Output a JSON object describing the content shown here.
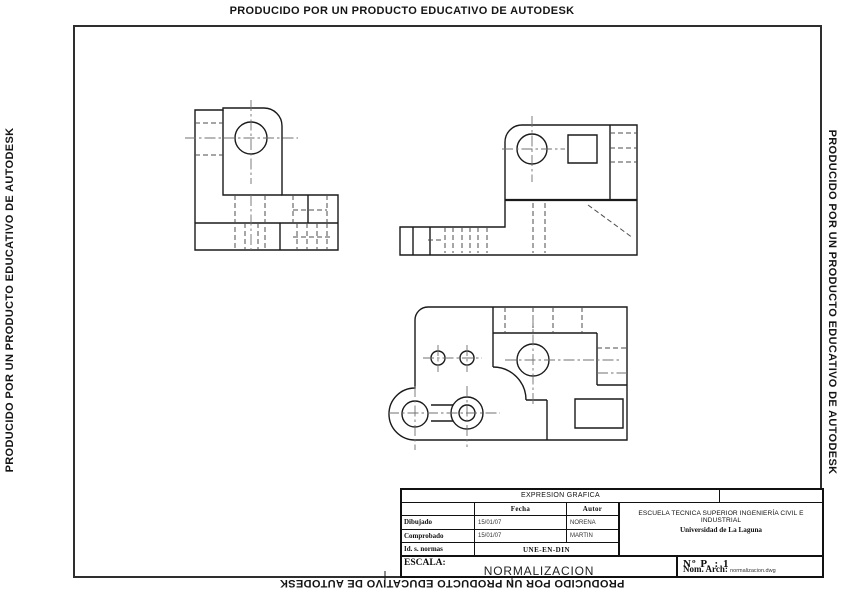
{
  "banners": {
    "top": "PRODUCIDO POR UN PRODUCTO EDUCATIVO DE AUTODESK",
    "left": "PRODUCIDO POR UN PRODUCTO EDUCATIVO DE AUTODESK",
    "right": "PRODUCIDO POR UN PRODUCTO EDUCATIVO DE AUTODESK",
    "bottom": "PRODUCIDO POR UN PRODUCTO EDUCATIVO DE AUTODESK"
  },
  "title_block": {
    "header": "EXPRESION GRAFICA",
    "columns": {
      "fecha": "Fecha",
      "autor": "Autor"
    },
    "rows": [
      {
        "label": "Dibujado",
        "fecha": "15/01/07",
        "autor": "NORENA"
      },
      {
        "label": "Comprobado",
        "fecha": "15/01/07",
        "autor": "MARTIN"
      }
    ],
    "norms_row": {
      "label": "Id. s. normas",
      "value": "UNE-EN-DIN"
    },
    "school": {
      "line1": "ESCUELA TECNICA SUPERIOR INGENIERÍA CIVIL E INDUSTRIAL",
      "line2": "Universidad de La Laguna"
    },
    "scale_label": "ESCALA:",
    "drawing_title": "NORMALIZACION",
    "sheet_number": "Nº P. : 1",
    "file_label": "Nom. Arch:",
    "file_name": "normalizacion.dwg"
  },
  "drawing": {
    "views": [
      "front-view",
      "side-view",
      "plan-view"
    ],
    "colors": {
      "line": "#1a1a1a",
      "hidden": "#4d4d4d",
      "centerline": "#707070",
      "frame": "#2e2e2e"
    }
  }
}
